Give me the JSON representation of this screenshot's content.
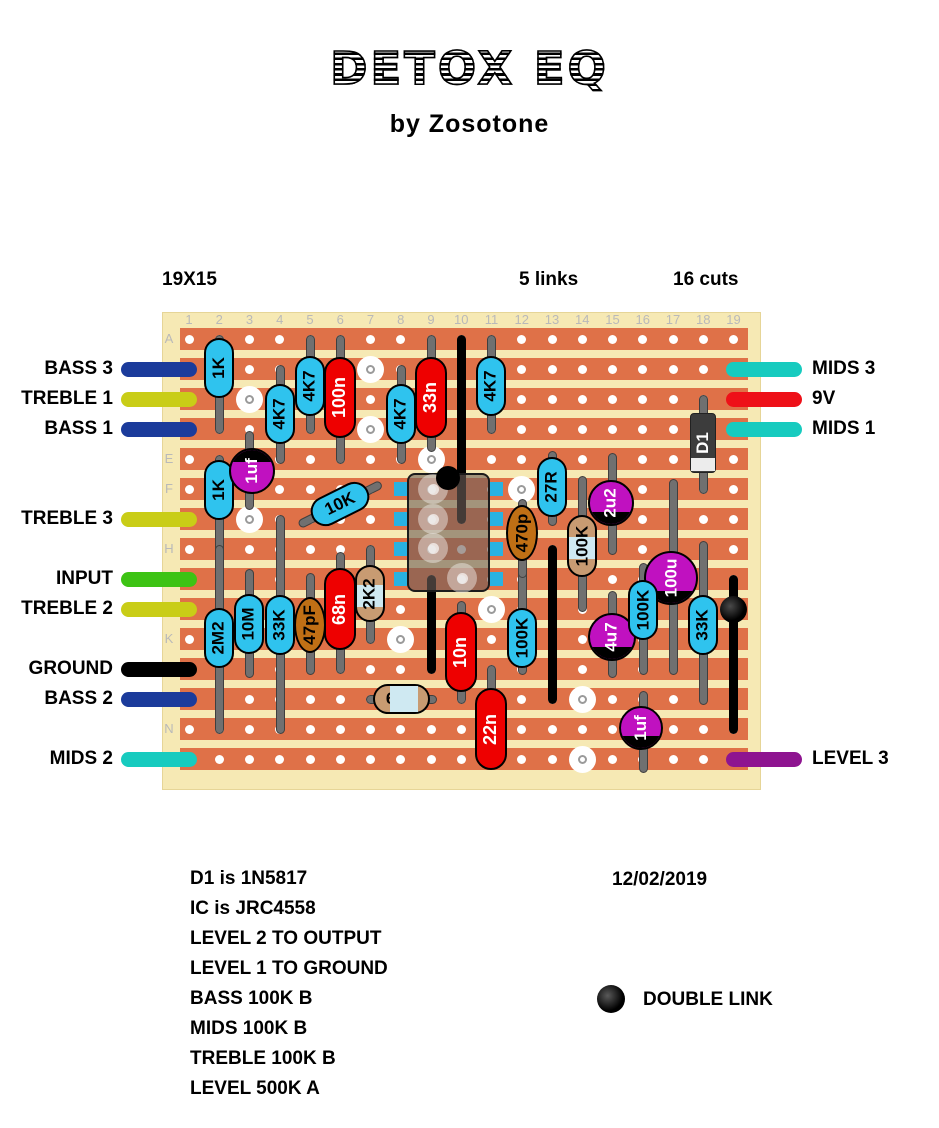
{
  "header": {
    "title": "DETOX EQ",
    "subtitle": "by Zosotone"
  },
  "board_meta": {
    "size": "19X15",
    "links_label": "5 links",
    "cuts_label": "16 cuts"
  },
  "footer": {
    "date": "12/02/2019",
    "legend_label": "DOUBLE LINK"
  },
  "notes": [
    "D1 is 1N5817",
    "IC is JRC4558",
    "LEVEL 2 TO OUTPUT",
    "LEVEL 1 TO GROUND",
    "BASS 100K B",
    "MIDS 100K B",
    "TREBLE 100K B",
    "LEVEL 500K A"
  ],
  "grid": {
    "col_labels": [
      "1",
      "2",
      "3",
      "4",
      "5",
      "6",
      "7",
      "8",
      "9",
      "10",
      "11",
      "12",
      "13",
      "14",
      "15",
      "16",
      "17",
      "18",
      "19"
    ],
    "row_labels": [
      "A",
      "B",
      "C",
      "D",
      "E",
      "F",
      "G",
      "H",
      "I",
      "J",
      "K",
      "L",
      "M",
      "N",
      "O"
    ]
  },
  "colors": {
    "board": "#f6e9b4",
    "strip": "#df7148",
    "hole": "#ffffff",
    "grid_text": "#b9b9b9",
    "lead": "#707070",
    "link": "#000000",
    "resistor": "#2fc3ee",
    "film_cap": "#ee0000",
    "ceramic_cap": "#c06f15",
    "metal_film": "#c89b72",
    "metal_film_band": "#cfe9f2",
    "electrolytic": "#c011c0",
    "diode_body": "#3c3c3c",
    "diode_band": "#ececec",
    "ic_pin": "#29b2e2",
    "navy": "#1b3b9b",
    "yellow": "#c9cd17",
    "green": "#3dc314",
    "teal": "#17cbbf",
    "red": "#ee1018",
    "purple": "#8e1490",
    "black": "#000000"
  },
  "pins": {
    "left": [
      {
        "label": "BASS 3",
        "row": "B",
        "color": "navy"
      },
      {
        "label": "TREBLE 1",
        "row": "C",
        "color": "yellow"
      },
      {
        "label": "BASS 1",
        "row": "D",
        "color": "navy"
      },
      {
        "label": "TREBLE 3",
        "row": "G",
        "color": "yellow"
      },
      {
        "label": "INPUT",
        "row": "I",
        "color": "green"
      },
      {
        "label": "TREBLE 2",
        "row": "J",
        "color": "yellow"
      },
      {
        "label": "GROUND",
        "row": "L",
        "color": "black"
      },
      {
        "label": "BASS 2",
        "row": "M",
        "color": "navy"
      },
      {
        "label": "MIDS 2",
        "row": "O",
        "color": "teal"
      }
    ],
    "right": [
      {
        "label": "MIDS 3",
        "row": "B",
        "color": "teal"
      },
      {
        "label": "9V",
        "row": "C",
        "color": "red"
      },
      {
        "label": "MIDS 1",
        "row": "D",
        "color": "teal"
      },
      {
        "label": "LEVEL 3",
        "row": "O",
        "color": "purple"
      }
    ]
  },
  "links": [
    {
      "col": 10,
      "from": "A",
      "to": "G"
    },
    {
      "col": 9,
      "from": "I",
      "to": "L"
    },
    {
      "col": 13,
      "from": "H",
      "to": "M"
    },
    {
      "col": 19,
      "from": "I",
      "to": "N",
      "dot_row": "J"
    }
  ],
  "cuts": [
    {
      "col": 3,
      "row": "C"
    },
    {
      "col": 3,
      "row": "G"
    },
    {
      "col": 7,
      "row": "B"
    },
    {
      "col": 7,
      "row": "D"
    },
    {
      "col": 9,
      "row": "E"
    },
    {
      "col": 12,
      "row": "F"
    },
    {
      "col": 11,
      "row": "J"
    },
    {
      "col": 8,
      "row": "K"
    },
    {
      "col": 14,
      "row": "M"
    },
    {
      "col": 14,
      "row": "O"
    }
  ],
  "components": [
    {
      "t": "res",
      "label": "1K",
      "x": 219,
      "lead": [
        339,
        429
      ],
      "body": [
        338,
        398
      ]
    },
    {
      "t": "res",
      "label": "4K7",
      "x": 280,
      "lead": [
        369,
        459
      ],
      "body": [
        384,
        444
      ]
    },
    {
      "t": "res",
      "label": "4K7",
      "x": 310,
      "lead": [
        339,
        429
      ],
      "body": [
        356,
        416
      ]
    },
    {
      "t": "res",
      "label": "4K7",
      "x": 401,
      "lead": [
        369,
        459
      ],
      "body": [
        384,
        444
      ]
    },
    {
      "t": "res",
      "label": "4K7",
      "x": 491,
      "lead": [
        339,
        429
      ],
      "body": [
        356,
        416
      ]
    },
    {
      "t": "res",
      "label": "1K",
      "x": 219,
      "lead": [
        459,
        549
      ],
      "body": [
        460,
        520
      ]
    },
    {
      "t": "res",
      "label": "27R",
      "x": 552,
      "lead": [
        455,
        521
      ],
      "body": [
        457,
        517
      ]
    },
    {
      "t": "res",
      "label": "2M2",
      "x": 219,
      "lead": [
        549,
        729
      ],
      "body": [
        608,
        668
      ]
    },
    {
      "t": "res",
      "label": "10M",
      "x": 249,
      "lead": [
        573,
        673
      ],
      "body": [
        594,
        654
      ]
    },
    {
      "t": "res",
      "label": "33K",
      "x": 280,
      "lead": [
        519,
        729
      ],
      "body": [
        595,
        655
      ]
    },
    {
      "t": "res",
      "label": "100K",
      "x": 522,
      "lead": [
        567,
        670
      ],
      "body": [
        608,
        668
      ]
    },
    {
      "t": "res",
      "label": "100K",
      "x": 643,
      "lead": [
        567,
        670
      ],
      "body": [
        580,
        640
      ]
    },
    {
      "t": "res",
      "label": "33K",
      "x": 703,
      "lead": [
        545,
        700
      ],
      "body": [
        595,
        655
      ]
    },
    {
      "t": "res_diag",
      "label": "10K",
      "cx": 340,
      "cy": 504,
      "angle": -26.5,
      "len": 92
    },
    {
      "t": "cap",
      "label": "100n",
      "x": 340,
      "lead": [
        339,
        459
      ],
      "body": [
        357,
        438
      ]
    },
    {
      "t": "cap",
      "label": "33n",
      "x": 431,
      "lead": [
        339,
        447
      ],
      "body": [
        357,
        438
      ]
    },
    {
      "t": "cap",
      "label": "68n",
      "x": 340,
      "lead": [
        556,
        669
      ],
      "body": [
        568,
        650
      ]
    },
    {
      "t": "cap",
      "label": "10n",
      "x": 461,
      "lead": [
        605,
        699
      ],
      "body": [
        612,
        692
      ]
    },
    {
      "t": "cap",
      "label": "22n",
      "x": 491,
      "lead": [
        669,
        759
      ],
      "body": [
        688,
        770
      ]
    },
    {
      "t": "disc",
      "label": "470p",
      "x": 522,
      "lead": [
        503,
        573
      ],
      "body": [
        505,
        561
      ]
    },
    {
      "t": "disc",
      "label": "47pF",
      "x": 310,
      "lead": [
        577,
        670
      ],
      "body": [
        597,
        653
      ]
    },
    {
      "t": "tan",
      "label": "2K2",
      "x": 370,
      "lead": [
        549,
        639
      ],
      "body": [
        565,
        622
      ]
    },
    {
      "t": "tan",
      "label": "100K",
      "x": 582,
      "lead": [
        480,
        607
      ],
      "body": [
        515,
        577
      ]
    },
    {
      "t": "tan_h",
      "label": "6K8",
      "y": 699,
      "lead": [
        370,
        432
      ],
      "body": [
        373,
        430
      ]
    },
    {
      "t": "diode",
      "label": "D1",
      "x": 703,
      "lead": [
        399,
        489
      ],
      "body": [
        413,
        473
      ]
    },
    {
      "t": "el",
      "label": "1uf",
      "cx": 252,
      "cy": 471,
      "r": 23,
      "pol": "top",
      "lx": 249,
      "lead": [
        435,
        505
      ],
      "front": true
    },
    {
      "t": "el",
      "label": "2u2",
      "cx": 611,
      "cy": 503,
      "r": 23,
      "pol": "bot",
      "lx": 612,
      "lead": [
        457,
        550
      ]
    },
    {
      "t": "el",
      "label": "100u",
      "cx": 671,
      "cy": 578,
      "r": 27,
      "pol": "bot",
      "lx": 673,
      "lead": [
        483,
        670
      ]
    },
    {
      "t": "el",
      "label": "4u7",
      "cx": 612,
      "cy": 637,
      "r": 24,
      "pol": "bot",
      "lx": 612,
      "lead": [
        595,
        673
      ]
    },
    {
      "t": "el",
      "label": "1uf",
      "cx": 641,
      "cy": 728,
      "r": 22,
      "pol": "bot",
      "lx": 643,
      "lead": [
        695,
        768
      ]
    }
  ],
  "ic": {
    "x1": 407,
    "x2": 490,
    "y1": 473,
    "y2": 592,
    "pin_rows": [
      "F",
      "G",
      "H",
      "I"
    ],
    "notch_x": 448,
    "holes": [
      [
        433,
        489
      ],
      [
        433,
        519
      ],
      [
        433,
        548
      ],
      [
        462,
        578
      ]
    ]
  },
  "geometry": {
    "col0": 189,
    "col_step": 30.25,
    "row0": 339,
    "row_step": 30,
    "board": [
      162,
      312,
      599,
      478
    ],
    "strip_x0": 180,
    "strip_x1": 748,
    "strip_h": 22,
    "wire_left_x": 121,
    "wire_right_x": 726,
    "wire_w": 76,
    "wire_h": 15
  }
}
